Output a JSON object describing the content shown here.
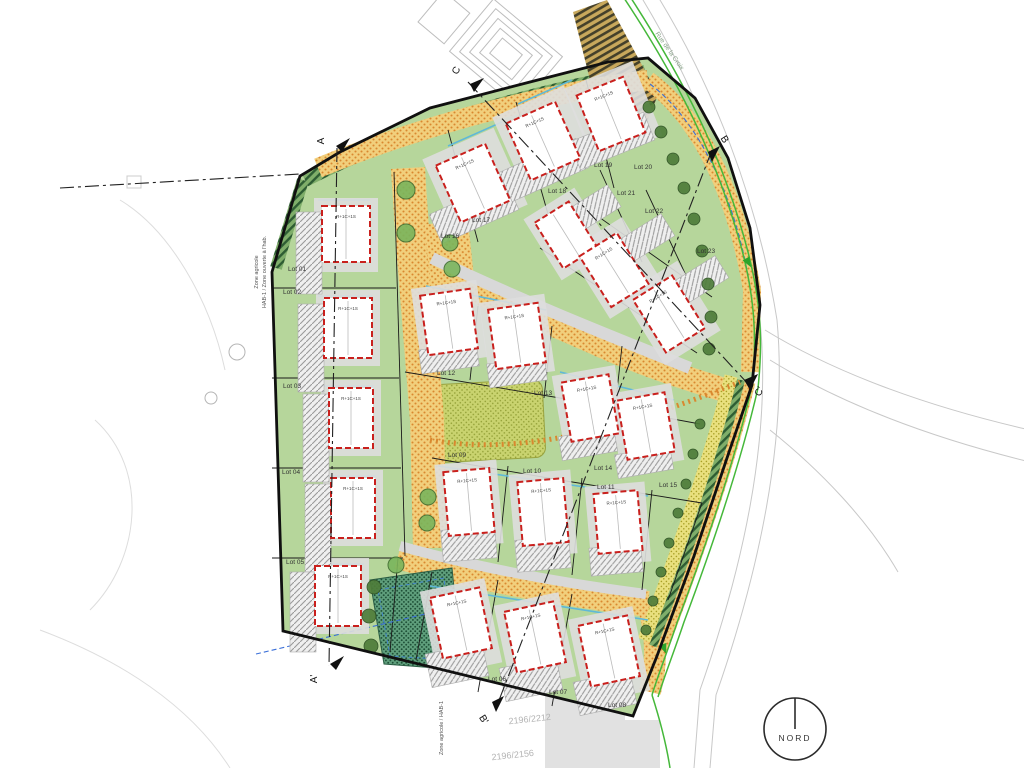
{
  "drawing": {
    "north_label": "NORD",
    "road_name": "Rue de la Croix",
    "zone_labels": {
      "left_line1": "Zone agricole",
      "left_line2": "HAB-1 / Zone ouverte à l'hab.",
      "bottom": "Zone agricole / HAB-1"
    },
    "parcel_numbers": {
      "upper": "2196/2212",
      "lower": "2196/2156"
    },
    "building_type_label": "R+1C+1S",
    "section_markers": {
      "a_top": "A",
      "a_bottom": "A'",
      "b_top": "B",
      "b_bottom": "B'",
      "c_top": "C",
      "c_right": "C'"
    },
    "lots": [
      {
        "label": "Lot 01"
      },
      {
        "label": "Lot 02"
      },
      {
        "label": "Lot 03"
      },
      {
        "label": "Lot 04"
      },
      {
        "label": "Lot 05"
      },
      {
        "label": "Lot 06"
      },
      {
        "label": "Lot 07"
      },
      {
        "label": "Lot 08"
      },
      {
        "label": "Lot 09"
      },
      {
        "label": "Lot 10"
      },
      {
        "label": "Lot 11"
      },
      {
        "label": "Lot 12"
      },
      {
        "label": "Lot 13"
      },
      {
        "label": "Lot 14"
      },
      {
        "label": "Lot 15"
      },
      {
        "label": "Lot 16"
      },
      {
        "label": "Lot 17"
      },
      {
        "label": "Lot 18"
      },
      {
        "label": "Lot 19"
      },
      {
        "label": "Lot 20"
      },
      {
        "label": "Lot 21"
      },
      {
        "label": "Lot 22"
      },
      {
        "label": "Lot 23"
      }
    ]
  }
}
